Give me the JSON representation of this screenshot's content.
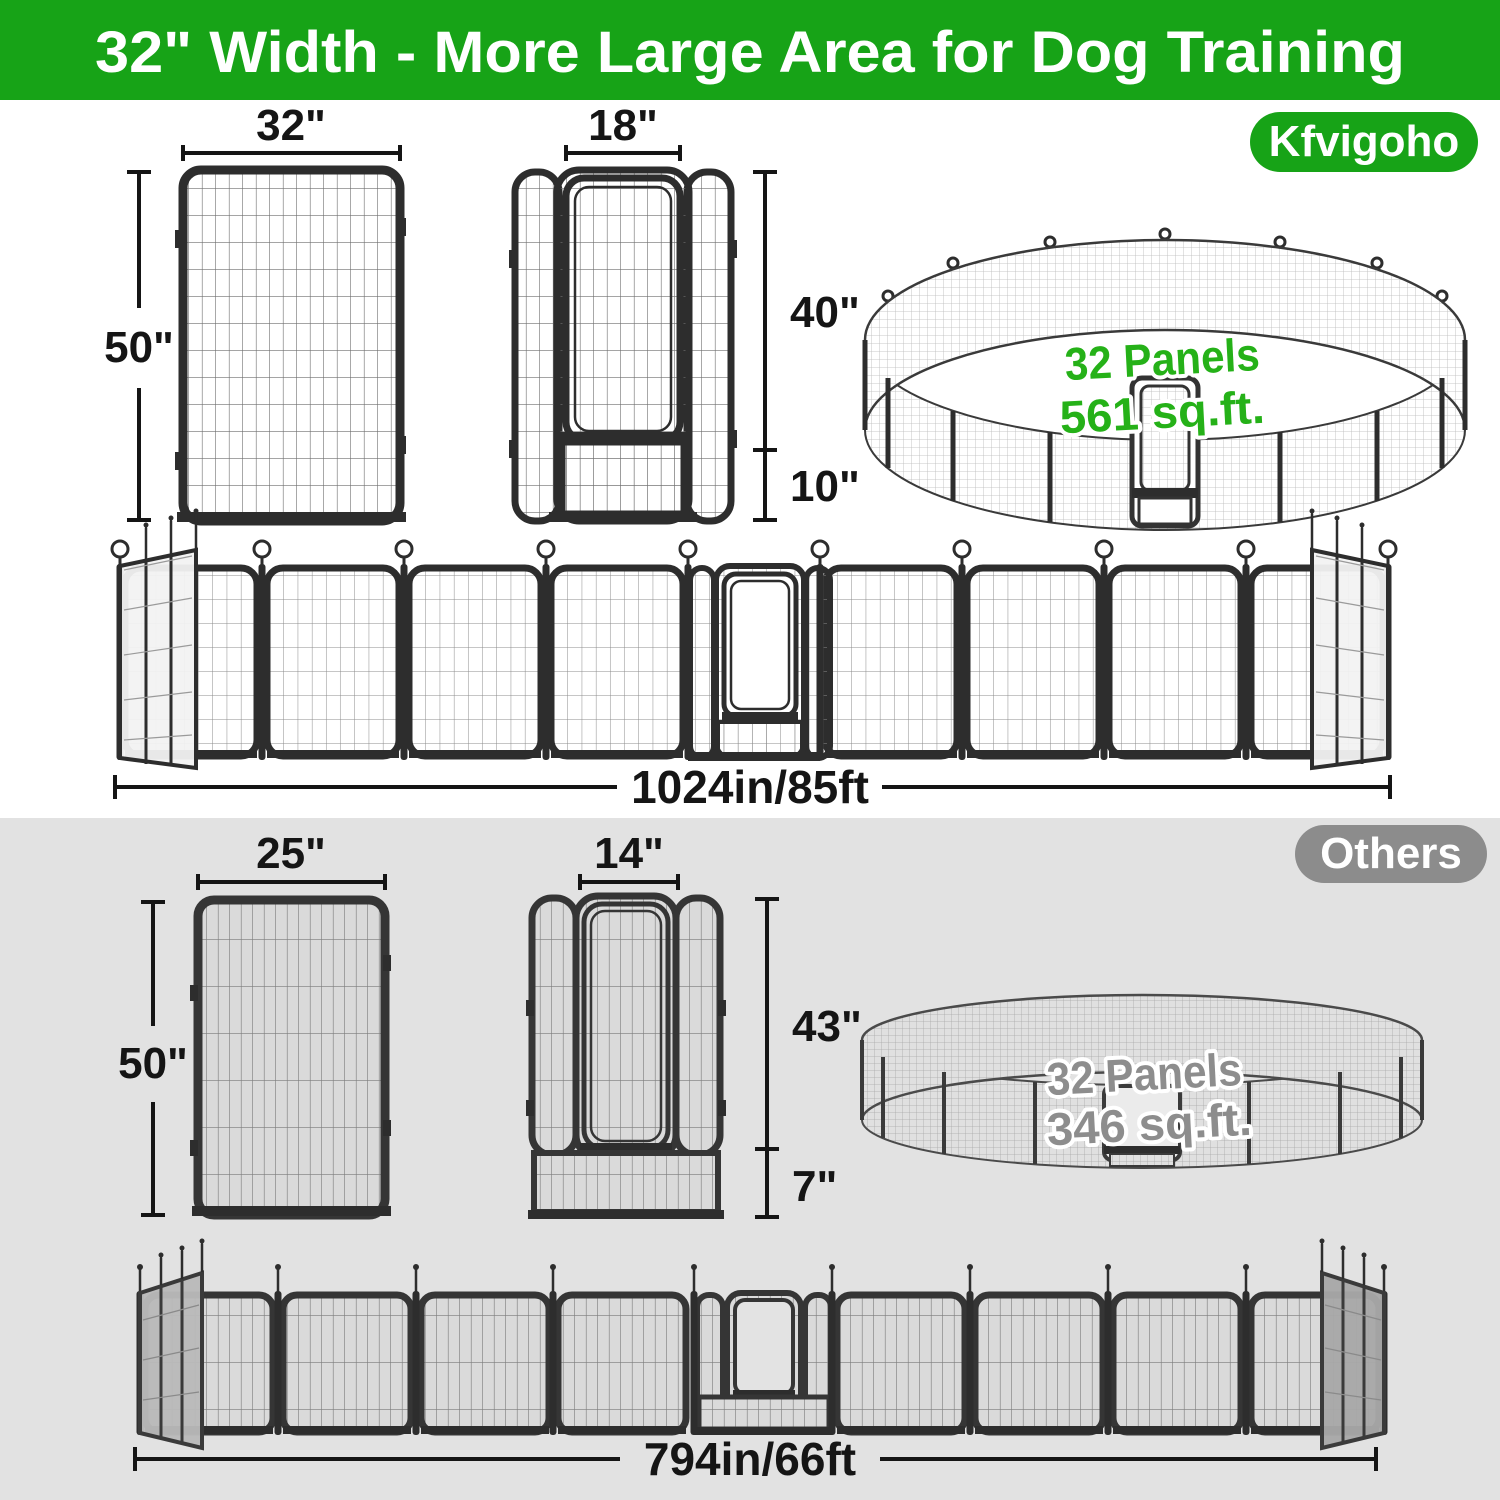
{
  "header": {
    "title": "32\" Width - More Large Area for Dog Training"
  },
  "kfvigoho": {
    "badge": "Kfvigoho",
    "panel_width": "32\"",
    "panel_height": "50\"",
    "door_width": "18\"",
    "door_height": "40\"",
    "bottom_height": "10\"",
    "pen_panels": "32 Panels",
    "pen_area": "561 sq.ft.",
    "row_length": "1024in/85ft"
  },
  "others": {
    "badge": "Others",
    "panel_width": "25\"",
    "panel_height": "50\"",
    "door_width": "14\"",
    "door_height": "43\"",
    "bottom_height": "7\"",
    "pen_panels": "32 Panels",
    "pen_area": "346 sq.ft.",
    "row_length": "794in/66ft"
  },
  "colors": {
    "brand_green": "#17A317",
    "accent_text_green": "#25B118",
    "others_gray": "#8C8C8C",
    "section_gray": "#E2E2E2",
    "dimension_text": "#151515"
  }
}
